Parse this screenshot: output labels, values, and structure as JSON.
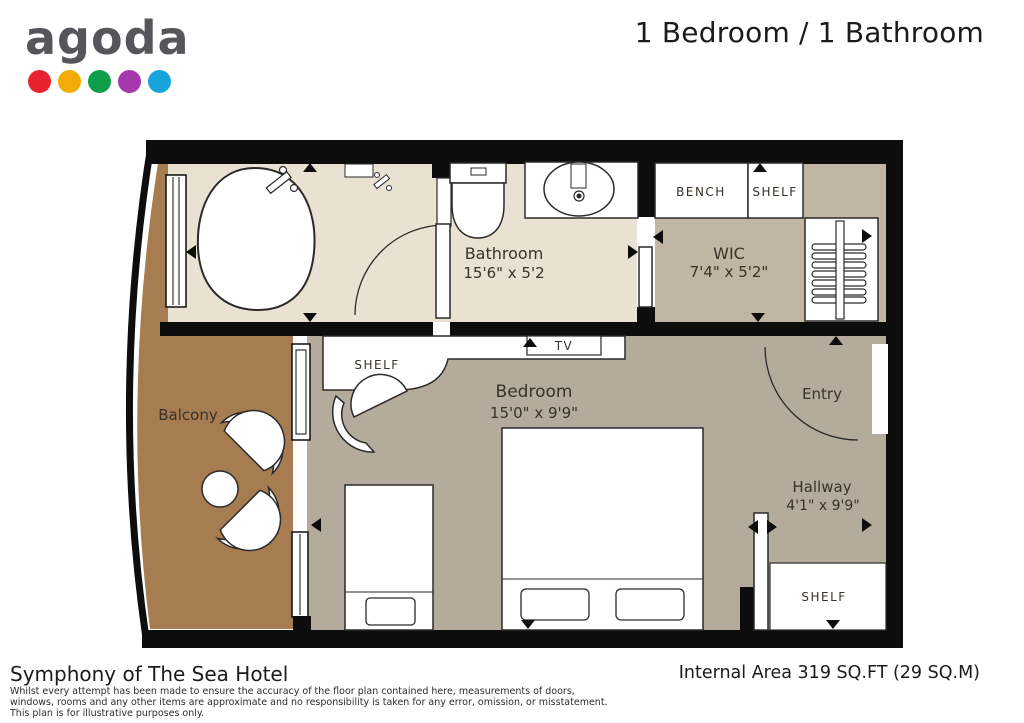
{
  "header": {
    "logo_text": "agoda",
    "logo_dot_colors": [
      "#e8222e",
      "#f2ac08",
      "#0e9e49",
      "#a538ae",
      "#18a3da"
    ],
    "title": "1 Bedroom / 1 Bathroom"
  },
  "floor_plan": {
    "rooms": {
      "bathroom": {
        "name": "Bathroom",
        "dims": "15'6\" x 5'2"
      },
      "wic": {
        "name": "WIC",
        "dims": "7'4\" x 5'2\""
      },
      "bedroom": {
        "name": "Bedroom",
        "dims": "15'0\" x 9'9\""
      },
      "hallway": {
        "name": "Hallway",
        "dims": "4'1\" x 9'9\""
      },
      "balcony": {
        "name": "Balcony"
      },
      "entry": {
        "name": "Entry"
      }
    },
    "labels": {
      "bench": "BENCH",
      "shelf_wic": "SHELF",
      "shelf_bedroom": "SHELF",
      "shelf_hallway": "SHELF",
      "tv": "TV"
    },
    "colors": {
      "wall": "#0d0d0d",
      "bathroom_floor": "#e9e2d3",
      "wic_floor": "#c1b5a3",
      "bedroom_floor": "#b5ab9d",
      "balcony_floor": "#a67c50"
    }
  },
  "footer": {
    "hotel_name": "Symphony of The Sea Hotel",
    "disclaimer": [
      "Whilst every attempt has been made to ensure the accuracy of the floor plan contained here, measurements of doors,",
      "windows, rooms and any other items are approximate and no responsibility is taken for any error, omission, or misstatement.",
      "This plan is for illustrative purposes only."
    ],
    "internal_area": "Internal Area 319 SQ.FT (29 SQ.M)"
  }
}
